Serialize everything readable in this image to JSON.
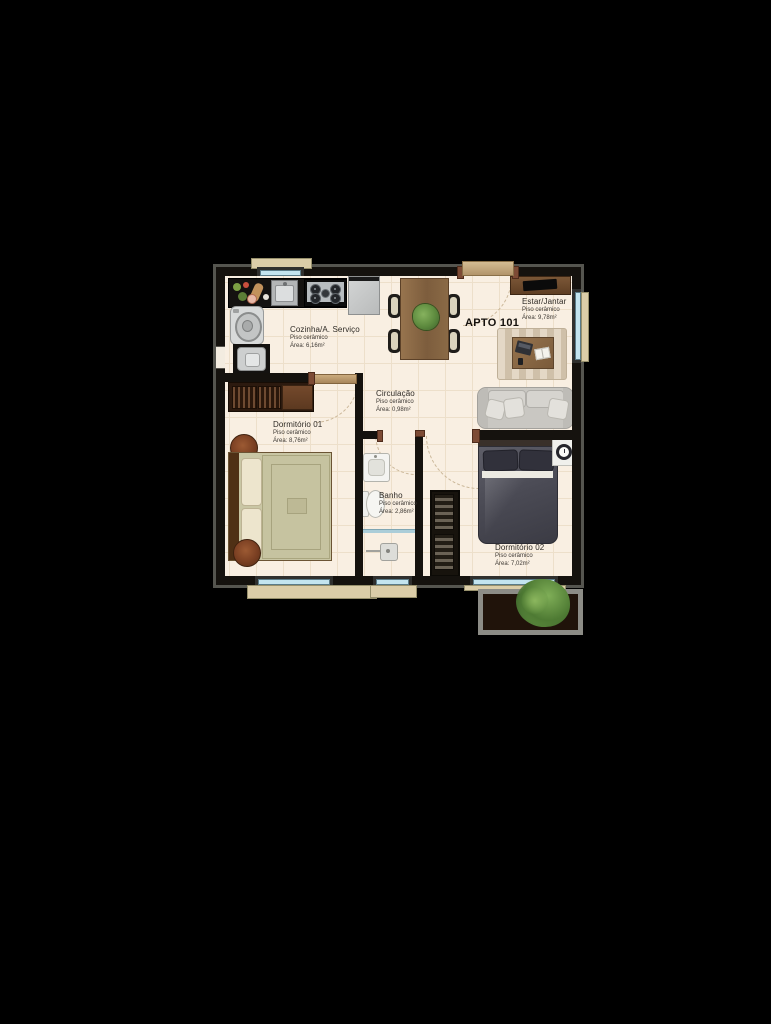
{
  "plan": {
    "apartment_label": "APTO 101",
    "rooms": [
      {
        "id": "cozinha",
        "name": "Cozinha/A. Serviço",
        "floor": "Piso cerâmico",
        "area": "Área: 6,16m²"
      },
      {
        "id": "estar",
        "name": "Estar/Jantar",
        "floor": "Piso cerâmico",
        "area": "Área: 9,78m²"
      },
      {
        "id": "circulacao",
        "name": "Circulação",
        "floor": "Piso cerâmico",
        "area": "Área: 0,98m²"
      },
      {
        "id": "dormitorio1",
        "name": "Dormitório 01",
        "floor": "Piso cerâmico",
        "area": "Área: 8,76m²"
      },
      {
        "id": "banho",
        "name": "Banho",
        "floor": "Piso cerâmico",
        "area": "Área: 2,86m²"
      },
      {
        "id": "dormitorio2",
        "name": "Dormitório 02",
        "floor": "Piso cerâmico",
        "area": "Área: 7,02m²"
      }
    ],
    "furniture": {
      "cozinha": [
        "countertop-food-prep",
        "kitchen-sink",
        "cooktop",
        "refrigerator",
        "washing-machine",
        "laundry-tank"
      ],
      "estar_jantar": [
        "dining-table",
        "dining-chair",
        "dining-chair",
        "dining-chair",
        "dining-chair",
        "plant-centerpiece",
        "tv-rack",
        "television",
        "area-rug",
        "coffee-table",
        "laptop",
        "open-book",
        "sofa",
        "throw-pillows"
      ],
      "dormitorio1": [
        "wardrobe",
        "double-bed",
        "pillows",
        "round-rug",
        "round-rug"
      ],
      "banho": [
        "washbasin",
        "toilet",
        "shower",
        "glass-partition"
      ],
      "dormitorio2": [
        "double-bed",
        "pillows",
        "nightstand",
        "wall-clock",
        "closet"
      ],
      "exterior": [
        "entry-door",
        "window-planter",
        "shrub"
      ]
    },
    "colors": {
      "background": "#000000",
      "floor": "#f9efe2",
      "walls": "#15120e",
      "window_glass": "#c3e4ef",
      "sill": "#dbcda8",
      "wood": "#8a6a48",
      "sofa_gray": "#c9c7c2",
      "bed1_bedding": "#c9c6a4",
      "bed2_bedding": "#46464f",
      "plant_green": "#6f9d4a",
      "pouf_brown": "#7a3f22"
    }
  }
}
